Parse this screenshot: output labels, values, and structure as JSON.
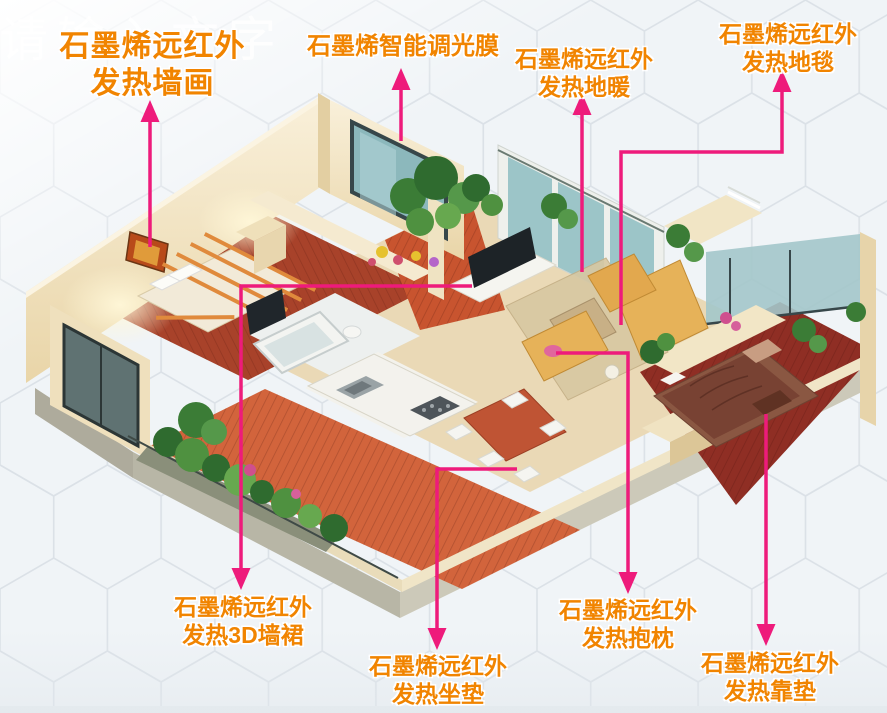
{
  "watermark": "请输入文字",
  "labels": {
    "wall_art": {
      "line1": "石墨烯远红外",
      "line2": "发热墙画"
    },
    "dimming_film": {
      "line1": "石墨烯智能调光膜"
    },
    "floor_heating": {
      "line1": "石墨烯远红外",
      "line2": "发热地暖"
    },
    "carpet": {
      "line1": "石墨烯远红外",
      "line2": "发热地毯"
    },
    "wall_skirt": {
      "line1": "石墨烯远红外",
      "line2": "发热3D墙裙"
    },
    "seat_cushion": {
      "line1": "石墨烯远红外",
      "line2": "发热坐垫"
    },
    "hug_pillow": {
      "line1": "石墨烯远红外",
      "line2": "发热抱枕"
    },
    "back_cushion": {
      "line1": "石墨烯远红外",
      "line2": "发热靠垫"
    }
  },
  "colors": {
    "label_orange": "#f18400",
    "arrow_pink": "#ee1b7b",
    "background": "#f0f4f7",
    "hexagon_line": "#d9dfe5",
    "watermark_color": "rgba(255,255,255,0.8)"
  }
}
